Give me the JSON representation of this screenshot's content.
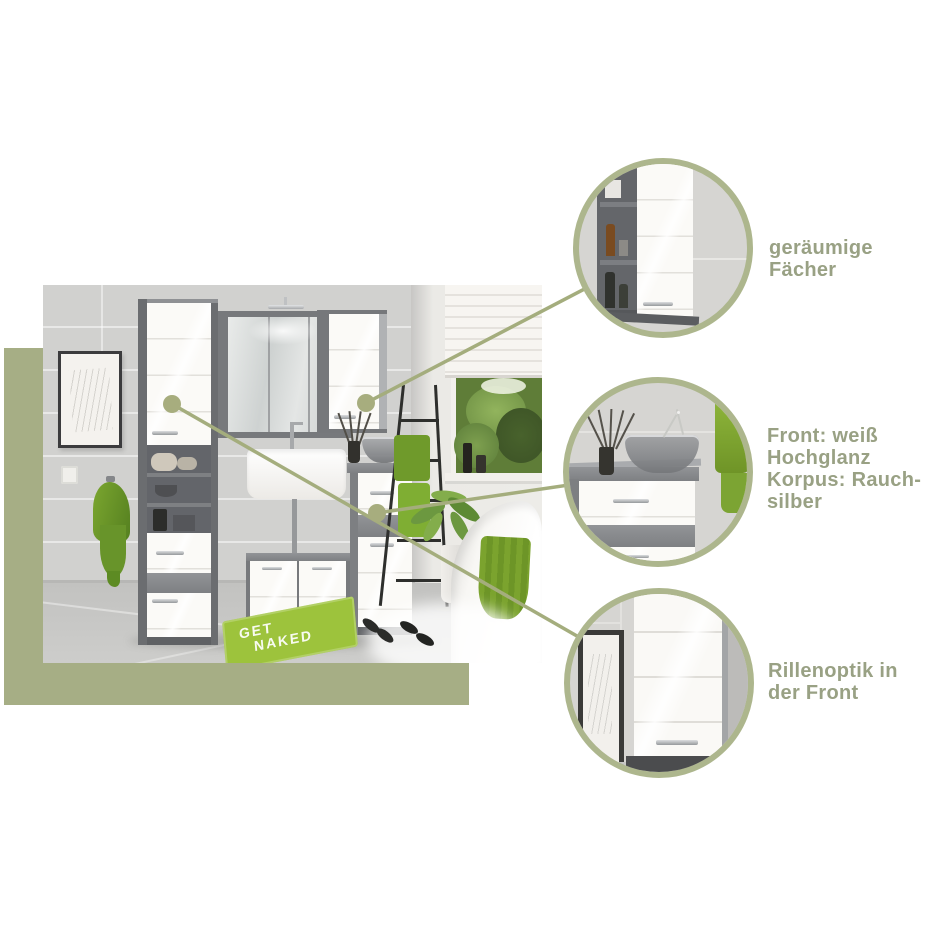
{
  "colors": {
    "page_bg": "#ffffff",
    "sage": "#a6ae85",
    "ring": "#adb68d",
    "line": "#a4ad7d",
    "dot": "#a7ad7e",
    "label_text": "#99a184",
    "rug_green": "#9dc33c",
    "towel_green": "#6f9a2b"
  },
  "callouts": [
    {
      "id": "spacious-shelves",
      "lines": [
        "geräumige",
        "Fächer"
      ]
    },
    {
      "id": "front-finish",
      "lines": [
        "Front: weiß",
        "Hochglanz",
        "Korpus: Rauch-",
        "silber"
      ]
    },
    {
      "id": "groove-front",
      "lines": [
        "Rillenoptik in",
        "der Front"
      ]
    }
  ],
  "photo": {
    "rug": {
      "line1": "GET",
      "line2": "NAKED"
    }
  }
}
